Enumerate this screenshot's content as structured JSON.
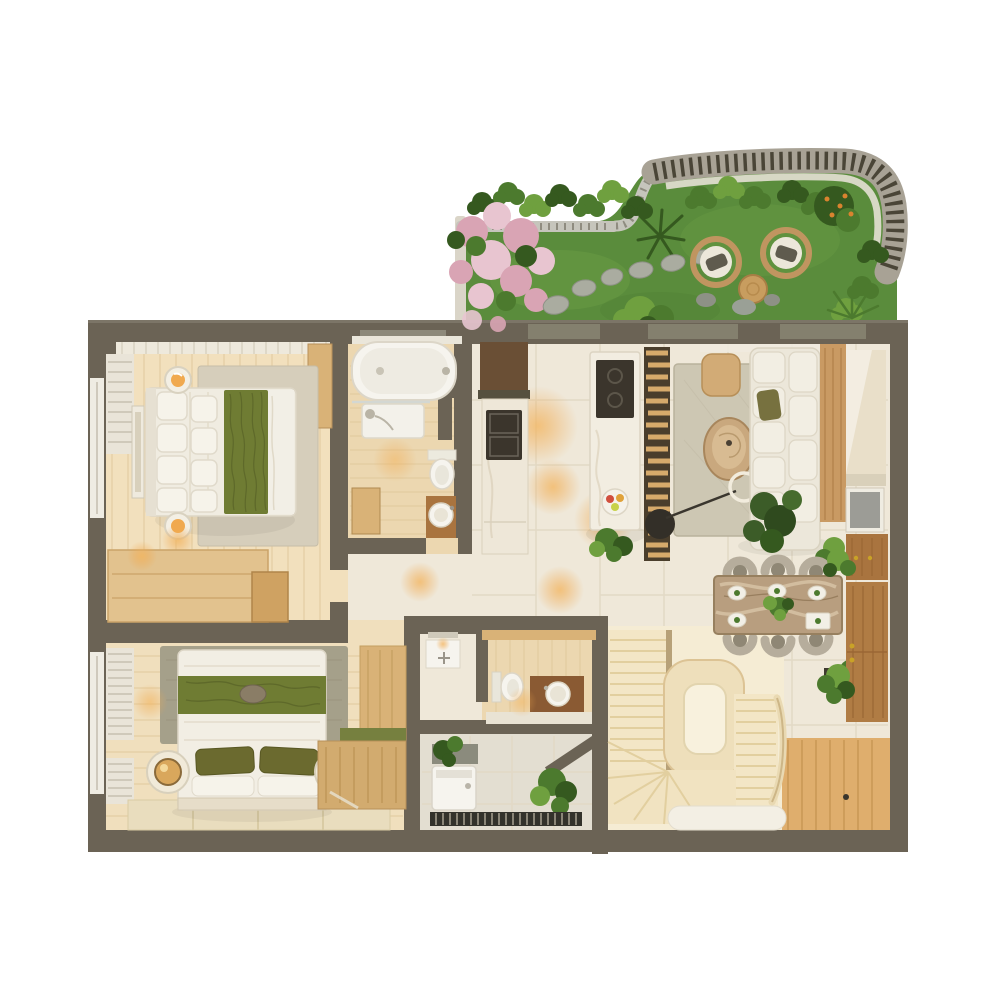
{
  "meta": {
    "title": "3D rendered apartment floor plan, top-down view",
    "view": "top-down axonometric render",
    "has_visible_text": false
  },
  "palette": {
    "bg": "#ffffff",
    "wall": "#6b6355",
    "wallHi": "#7c7567",
    "wallDark": "#56503f",
    "tileFloor": "#efe8d9",
    "tileLine": "#e2d9c6",
    "woodFloorLight": "#f2e0bd",
    "woodPlankLine": "#e0c99d",
    "woodBath": "#ecd7b0",
    "woodMid": "#d9b277",
    "woodDark": "#a9743f",
    "woodDeep": "#6a4f35",
    "marble": "#eee7d8",
    "whitegoods": "#f6f4ee",
    "cushion": "#ece7da",
    "cushionEdge": "#d9d2c0",
    "oliveGreen": "#6f7c33",
    "oliveDark": "#5a6428",
    "olivePillow": "#6b6a2f",
    "rugBeige": "#d6cebb",
    "rugGray": "#a5a08a",
    "rugLiving": "#cdc7b3",
    "grass": "#5a8c3c",
    "grassLight": "#76a94c",
    "leaf": "#4c7a2e",
    "leafDark": "#35591f",
    "leafLight": "#6fa03f",
    "pink": "#d9a4b4",
    "pinkLight": "#e8c5d0",
    "stone": "#aaaca0",
    "railing": "#c6c5bc",
    "pergola": "#a8a295",
    "pergolaSlat": "#4a4537",
    "glow": "#f0a94f",
    "appliance": "#3b352c",
    "tvScreen": "#9c9c96",
    "tan": "#c9a87e",
    "diningMarble": "#b89e7f",
    "diningVeinLight": "#d6c2a4",
    "diningVeinDark": "#8a7050",
    "chairGray": "#b6ad9c",
    "chairSeat": "#8f8775",
    "stairsWood": "#f3e6c6",
    "stairsLine": "#e2cf9f",
    "stairsPale": "#f5ecd4",
    "tatami": "#e9ddbe",
    "utilityFloor": "#e3ded1",
    "louver": "#33322b",
    "hallWood": "#dfae6d",
    "hallWoodLine": "#c4924f"
  },
  "scene": {
    "garden": {
      "name": "roof-garden-terrace",
      "elements": [
        "grass-lawn",
        "curved-railing",
        "slatted-pergola-band",
        "white-planter",
        "pink-flowering-bush",
        "shrub-clusters",
        "orange-berry-bush",
        "stepping-stone-path",
        "two-wicker-lounge-chairs",
        "round-side-table",
        "decorative-rocks",
        "ornamental-grasses"
      ]
    },
    "rooms": [
      {
        "name": "master-bedroom",
        "position": "top-left",
        "furniture": [
          "double-bed-with-green-runner",
          "area-rug",
          "two-round-bedside-lamps",
          "wall-art-frame",
          "wardrobe",
          "dresser-cabinets",
          "window-curtains"
        ]
      },
      {
        "name": "main-bathroom",
        "position": "top-middle",
        "furniture": [
          "bathtub",
          "shower",
          "toilet",
          "round-basin-on-wood-counter",
          "wood-bench"
        ]
      },
      {
        "name": "kitchen",
        "position": "center",
        "furniture": [
          "tall-cabinet-column",
          "double-oven-stack",
          "marble-island-with-cooktop",
          "fruit-bowl",
          "slatted-wood-partition",
          "potted-plant"
        ]
      },
      {
        "name": "living-room",
        "position": "right",
        "furniture": [
          "l-shaped-white-sofa",
          "living-rug",
          "round-travertine-coffee-table",
          "arc-floor-lamp",
          "side-table",
          "floor-plant",
          "tv",
          "tv-console",
          "media-wall-panel"
        ]
      },
      {
        "name": "dining-area",
        "position": "center-right",
        "furniture": [
          "marble-dining-table",
          "six-chairs",
          "plates",
          "centerpiece-plant",
          "storage-cabinet",
          "potted-plants"
        ]
      },
      {
        "name": "second-bedroom",
        "position": "bottom-left",
        "furniture": [
          "bed-with-olive-pillows",
          "round-rattan-lamps",
          "gray-green-rug",
          "tatami-mats",
          "wood-desk-wardrobe-unit",
          "window-blinds"
        ]
      },
      {
        "name": "water-closet",
        "position": "bottom-middle",
        "furniture": [
          "toilet",
          "wood-vanity-with-round-basin",
          "utility-niche-with-faucet"
        ]
      },
      {
        "name": "utility-laundry",
        "position": "bottom-middle-lower",
        "furniture": [
          "washing-machine",
          "counter",
          "potted-plants",
          "louvered-vent"
        ]
      },
      {
        "name": "staircase",
        "position": "bottom-right",
        "furniture": [
          "upper-flight",
          "curved-landing-ring",
          "lower-flight",
          "winder-steps",
          "curved-handrail"
        ]
      },
      {
        "name": "entry-hall",
        "position": "bottom-right-corner",
        "furniture": [
          "wood-plank-floor",
          "wall-cabinet",
          "wall-plant",
          "white-runner-rug"
        ]
      }
    ]
  }
}
